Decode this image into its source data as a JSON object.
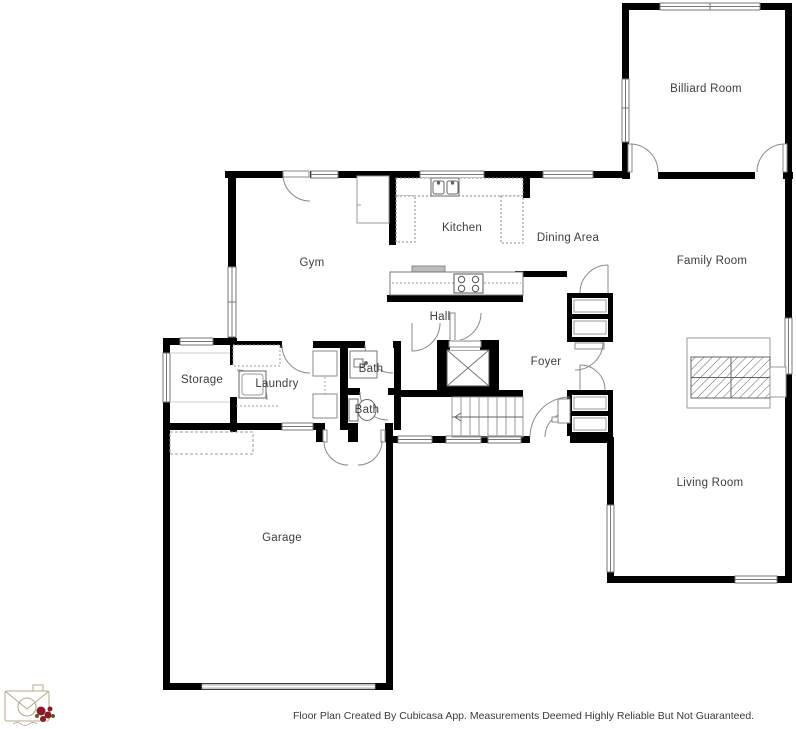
{
  "plan": {
    "rooms": {
      "billiard": {
        "label": "Billiard Room"
      },
      "family": {
        "label": "Family Room"
      },
      "living": {
        "label": "Living Room"
      },
      "gym": {
        "label": "Gym"
      },
      "kitchen": {
        "label": "Kitchen"
      },
      "dining": {
        "label": "Dining Area"
      },
      "hall": {
        "label": "Hall"
      },
      "foyer": {
        "label": "Foyer"
      },
      "storage": {
        "label": "Storage"
      },
      "laundry": {
        "label": "Laundry"
      },
      "bath_upper": {
        "label": "Bath"
      },
      "bath_lower": {
        "label": "Bath"
      },
      "garage": {
        "label": "Garage"
      }
    },
    "footer": {
      "disclaimer": "Floor Plan Created By Cubicasa App. Measurements Deemed Highly Reliable But Not Guaranteed."
    },
    "branding": {
      "logo_icon": "camera-with-roses-logo"
    },
    "colors": {
      "wall": "#000000",
      "background": "#ffffff",
      "label_text": "#3d3d3d",
      "rose_red": "#8a1a28",
      "logo_line": "#b3a88e"
    }
  }
}
